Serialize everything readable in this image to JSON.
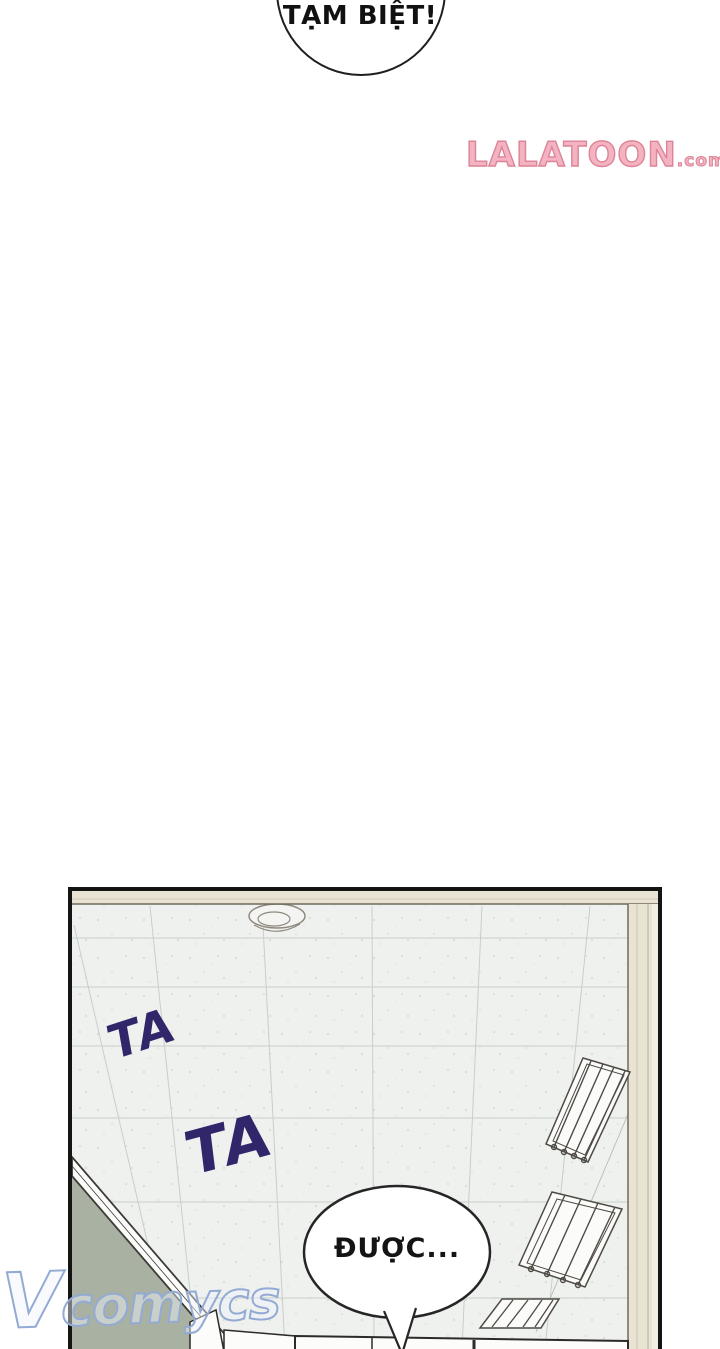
{
  "top_bubble": {
    "text": "TẠM BIỆT!"
  },
  "watermark_top": {
    "name": "LALATOON",
    "suffix": ".com"
  },
  "watermark_bottom": {
    "initial": "V",
    "rest": "comycs"
  },
  "panel": {
    "sfx_1": "TA",
    "sfx_2": "TA",
    "bubble_text": "ĐƯỢC..."
  },
  "colors": {
    "sfx_purple": "#32266b",
    "lalatoon_fill": "#f4b3c0",
    "lalatoon_outline": "#dd8498",
    "vcomycs_blue": "#93abd4",
    "ceiling": "#eff1ef",
    "beam_beige": "#e9e3d3",
    "wall_green": "#a9b1a2",
    "panel_border": "#141414",
    "bubble_fill": "#ffffff",
    "ink": "#262626"
  }
}
